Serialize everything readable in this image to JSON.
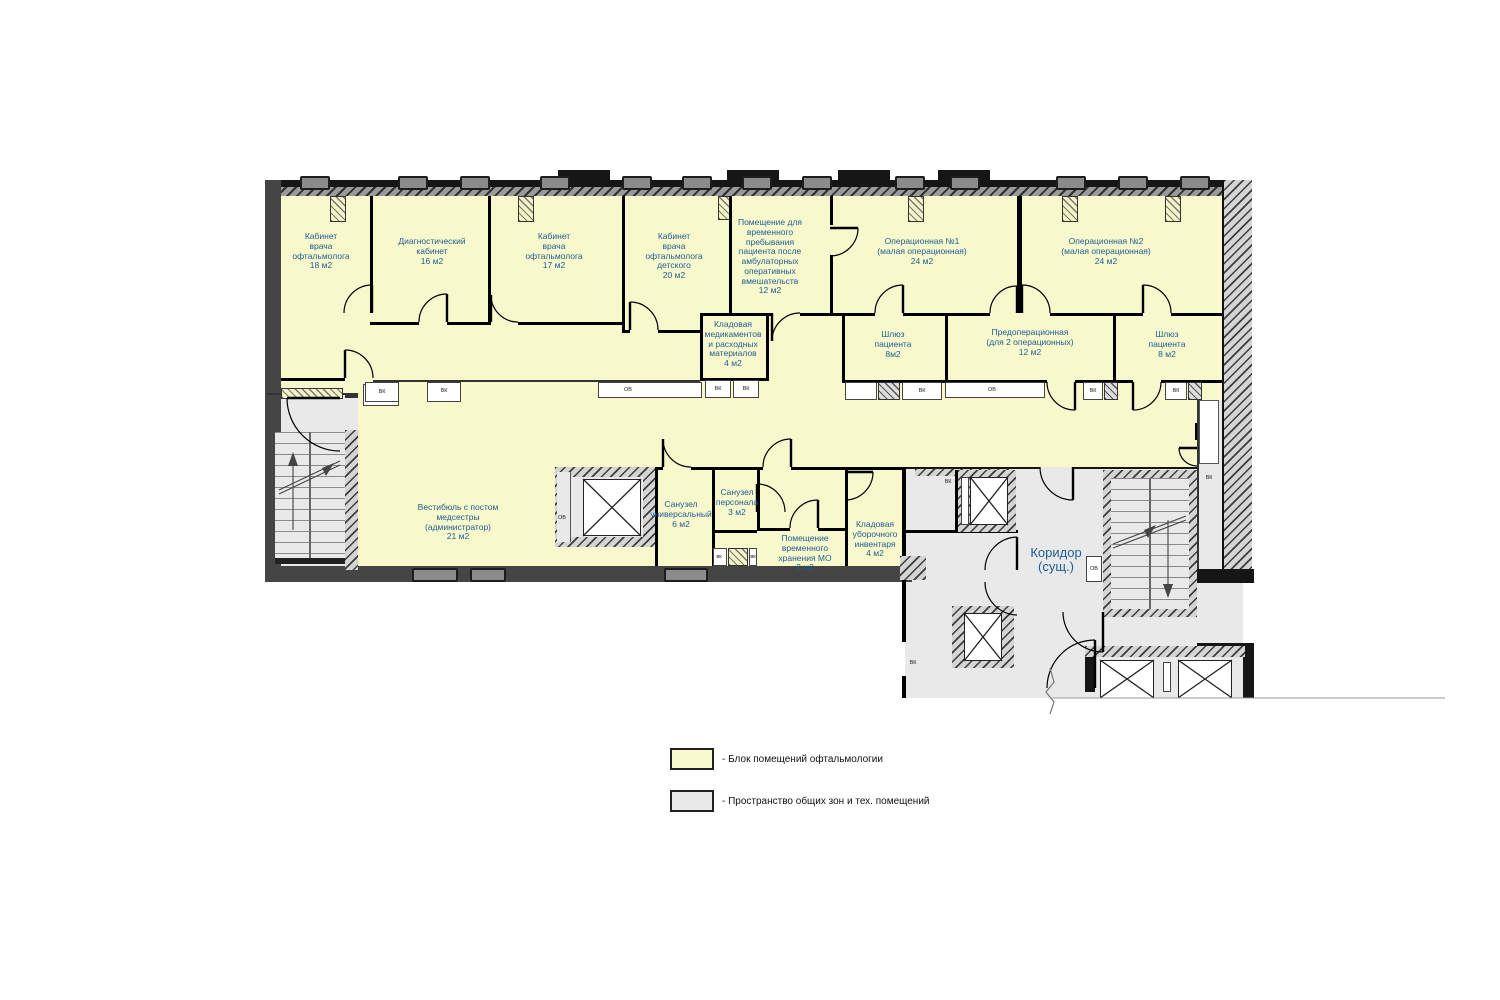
{
  "colors": {
    "ophthalmology_block": "#f8f8cd",
    "common_zones": "#e9e9e9",
    "wall": "#161616",
    "room_label_text": "#1d5d91"
  },
  "rooms": [
    {
      "id": "exam-room-ophthalmologist-18",
      "label": "Кабинет\nврача\nофтальмолога\n18 м2"
    },
    {
      "id": "diagnostic-room-16",
      "label": "Диагностический\nкабинет\n16 м2"
    },
    {
      "id": "exam-room-ophthalmologist-17",
      "label": "Кабинет\nврача\nофтальмолога\n17 м2"
    },
    {
      "id": "exam-room-pediatric-20",
      "label": "Кабинет\nврача\nофтальмолога\nдетского\n20 м2"
    },
    {
      "id": "temporary-stay-room-12",
      "label": "Помещение для\nвременного\nпребывания\nпациента после\nамбулаторных\nоперативных\nвмешательств\n12 м2"
    },
    {
      "id": "operating-room-1",
      "label": "Операционная №1\n(малая операционная)\n24 м2"
    },
    {
      "id": "operating-room-2",
      "label": "Операционная №2\n(малая операционная)\n24 м2"
    },
    {
      "id": "storage-medications-4",
      "label": "Кладовая\nмедикаментов\nи расходных\nматериалов\n4 м2"
    },
    {
      "id": "patient-airlock-left-8",
      "label": "Шлюз\nпациента\n8м2"
    },
    {
      "id": "preoperative-room-12",
      "label": "Предоперационная\n(для 2 операционных)\n12 м2"
    },
    {
      "id": "patient-airlock-right-8",
      "label": "Шлюз\nпациента\n8 м2"
    },
    {
      "id": "vestibule-nurse-post-21",
      "label": "Вестибюль с постом\nмедсестры\n(администратор)\n21 м2"
    },
    {
      "id": "universal-bathroom-6",
      "label": "Санузел\nуниверсальный\n6 м2"
    },
    {
      "id": "staff-bathroom-3",
      "label": "Санузел\nперсонала\n3 м2"
    },
    {
      "id": "temporary-storage-mo-3",
      "label": "Помещение\nвременного\nхранения МО\n3 м2"
    },
    {
      "id": "cleaning-storage-4",
      "label": "Кладовая\nуборочного\nинвентаря\n4 м2"
    },
    {
      "id": "corridor-existing",
      "label": "Коридор\n(сущ.)"
    }
  ],
  "shaft_labels": [
    {
      "text": "ВК",
      "x": 382,
      "y": 392
    },
    {
      "text": "ВК",
      "x": 444,
      "y": 391
    },
    {
      "text": "ОВ",
      "x": 628,
      "y": 390
    },
    {
      "text": "ВК",
      "x": 718,
      "y": 389
    },
    {
      "text": "ВК",
      "x": 746,
      "y": 389
    },
    {
      "text": "ВК",
      "x": 922,
      "y": 391
    },
    {
      "text": "ОВ",
      "x": 992,
      "y": 390
    },
    {
      "text": "ВК",
      "x": 1093,
      "y": 391
    },
    {
      "text": "ВК",
      "x": 1176,
      "y": 391
    },
    {
      "text": "ВК",
      "x": 948,
      "y": 482
    },
    {
      "text": "ОВ",
      "x": 562,
      "y": 518
    },
    {
      "text": "вк",
      "x": 719,
      "y": 557
    },
    {
      "text": "вк",
      "x": 753,
      "y": 557
    },
    {
      "text": "ВК",
      "x": 1209,
      "y": 478
    },
    {
      "text": "ОВ",
      "x": 1094,
      "y": 569
    },
    {
      "text": "ВК",
      "x": 913,
      "y": 663
    }
  ],
  "legend": {
    "items": [
      {
        "swatch": "#f8f8cd",
        "label": "- Блок помещений офтальмологии"
      },
      {
        "swatch": "#e9e9e9",
        "label": "- Пространство общих зон и тех. помещений"
      }
    ]
  }
}
